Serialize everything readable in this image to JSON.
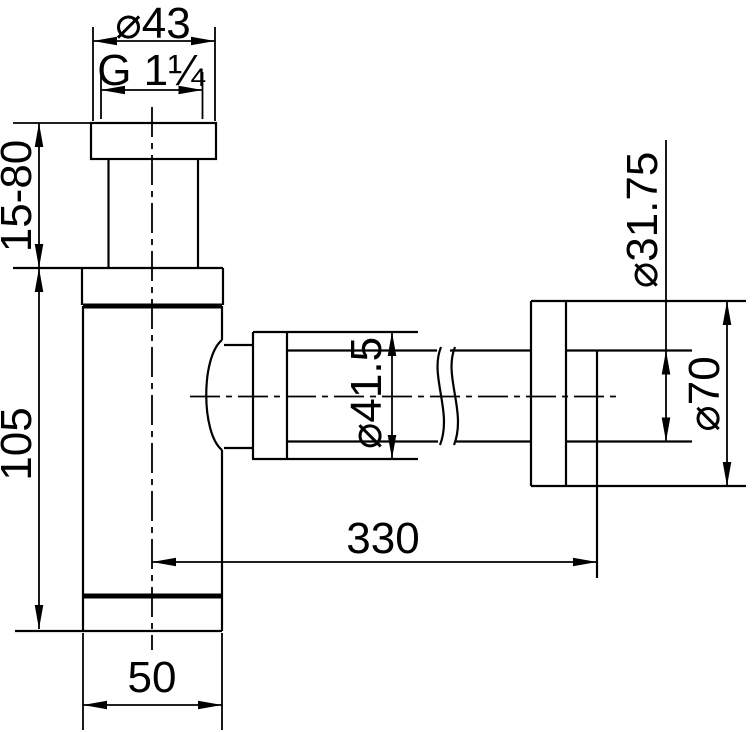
{
  "drawing": {
    "labels": {
      "cap_diameter": "⌀43",
      "thread": "G 1¼",
      "inlet_adjustable_height": "15-80",
      "body_height": "105",
      "nut_diameter": "⌀41.5",
      "pipe_length": "330",
      "body_width": "50",
      "pipe_diameter": "⌀31.75",
      "rosette_diameter": "⌀70"
    },
    "colors": {
      "line": "#000000",
      "background": "#ffffff"
    }
  }
}
